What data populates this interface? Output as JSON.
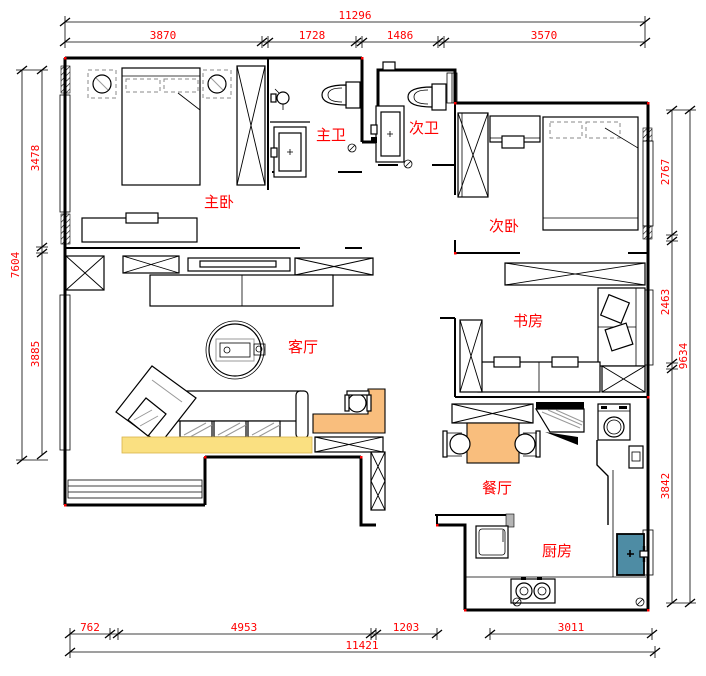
{
  "meta": {
    "drawing_type": "apartment floor plan",
    "annotation_units": "mm"
  },
  "dims": {
    "top": {
      "total": "11296",
      "segments": [
        "3870",
        "1728",
        "1486",
        "3570"
      ]
    },
    "left": {
      "total": "7604",
      "segments": [
        "3478",
        "3885"
      ]
    },
    "right": {
      "total": "9634",
      "segments": [
        "2767",
        "2463",
        "3842"
      ]
    },
    "bottom": {
      "total": "11421",
      "segments": [
        "762",
        "4953",
        "1203",
        "3011"
      ]
    }
  },
  "rooms": {
    "master_bedroom": "主卧",
    "master_bath": "主卫",
    "second_bath": "次卫",
    "second_bedroom": "次卧",
    "study": "书房",
    "living": "客厅",
    "dining": "餐厅",
    "kitchen": "厨房"
  },
  "colors": {
    "annotation_red": "#FF0000",
    "wall_black": "#000000",
    "sofa_rug_yellow": "#FAE081",
    "desk_orange": "#F9BE7D",
    "dining_table_orange": "#F9BE7D",
    "sink_teal": "#4E8CA4",
    "background": "#FFFFFF"
  }
}
